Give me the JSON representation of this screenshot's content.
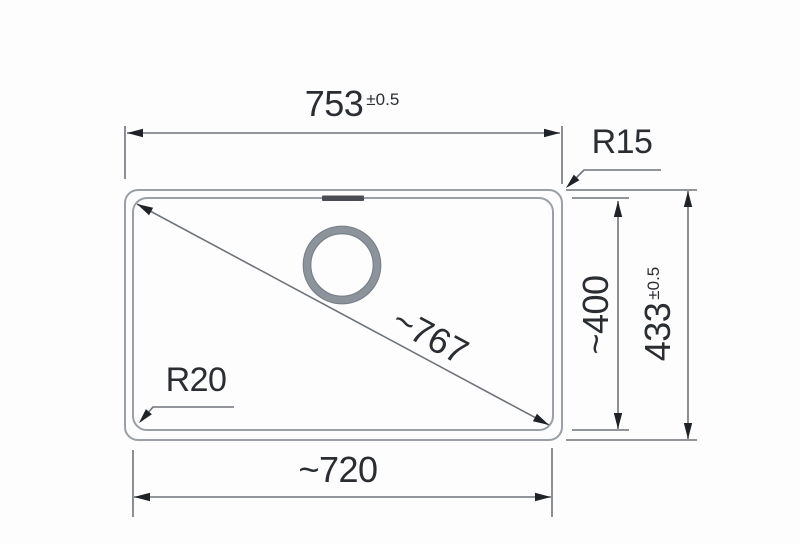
{
  "drawing": {
    "type": "technical-dimension-drawing",
    "subject": "sink bowl top view with dimensions",
    "labels": {
      "width_outer": {
        "value": "753",
        "tolerance": "±0.5"
      },
      "radius_top_right": "R15",
      "diagonal": "~767",
      "radius_bottom_left": "R20",
      "width_inner": "~720",
      "depth_inner": "~400",
      "depth_outer": {
        "value": "433",
        "tolerance": "±0.5"
      }
    },
    "colors": {
      "bg": "#fdfdfd",
      "outline": "#9aa0a6",
      "dimline": "#6f747b",
      "arrow": "#1f2328",
      "text": "#2a2d31",
      "slot": "#4a4e54",
      "ring": "#8d939b"
    }
  }
}
